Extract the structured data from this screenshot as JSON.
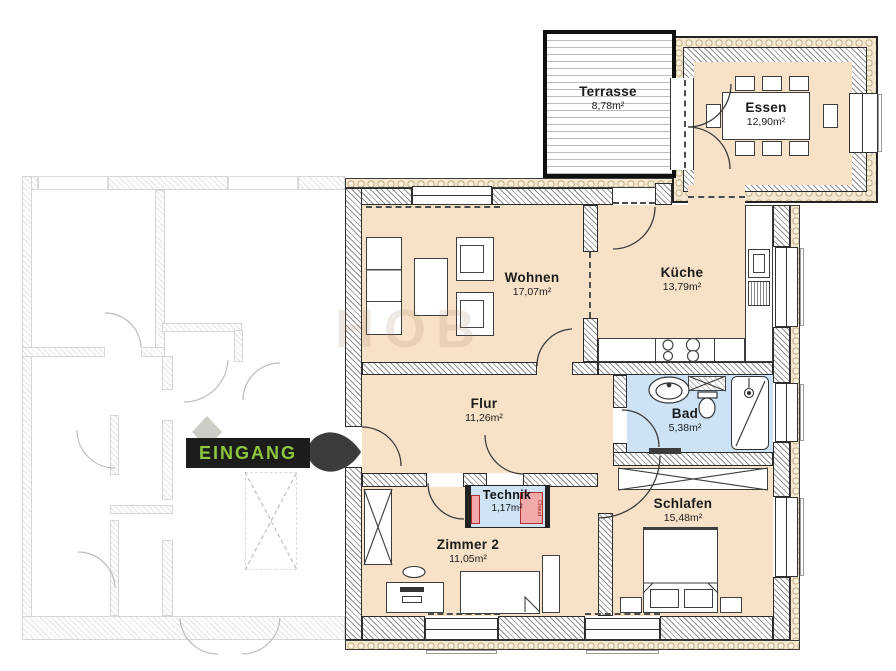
{
  "watermark": {
    "text": "HOB"
  },
  "entrance": {
    "label": "EINGANG"
  },
  "colors": {
    "floor": "#f8e2c7",
    "wet_room": "#cde3f5",
    "accent_green": "#8dc63f",
    "badge_bg": "#1c1c1a",
    "technik_unit": "#f2a9a9"
  },
  "rooms": {
    "terrasse": {
      "name": "Terrasse",
      "area": "8,78m²"
    },
    "essen": {
      "name": "Essen",
      "area": "12,90m²"
    },
    "wohnen": {
      "name": "Wohnen",
      "area": "17,07m²"
    },
    "kueche": {
      "name": "Küche",
      "area": "13,79m²"
    },
    "flur": {
      "name": "Flur",
      "area": "11,26m²"
    },
    "bad": {
      "name": "Bad",
      "area": "5,38m²"
    },
    "technik": {
      "name": "Technik",
      "area": "1,17m²"
    },
    "zimmer2": {
      "name": "Zimmer 2",
      "area": "11,05m²"
    },
    "schlafen": {
      "name": "Schlafen",
      "area": "15,48m²"
    }
  },
  "labels": {
    "chaud": "Chaud"
  }
}
